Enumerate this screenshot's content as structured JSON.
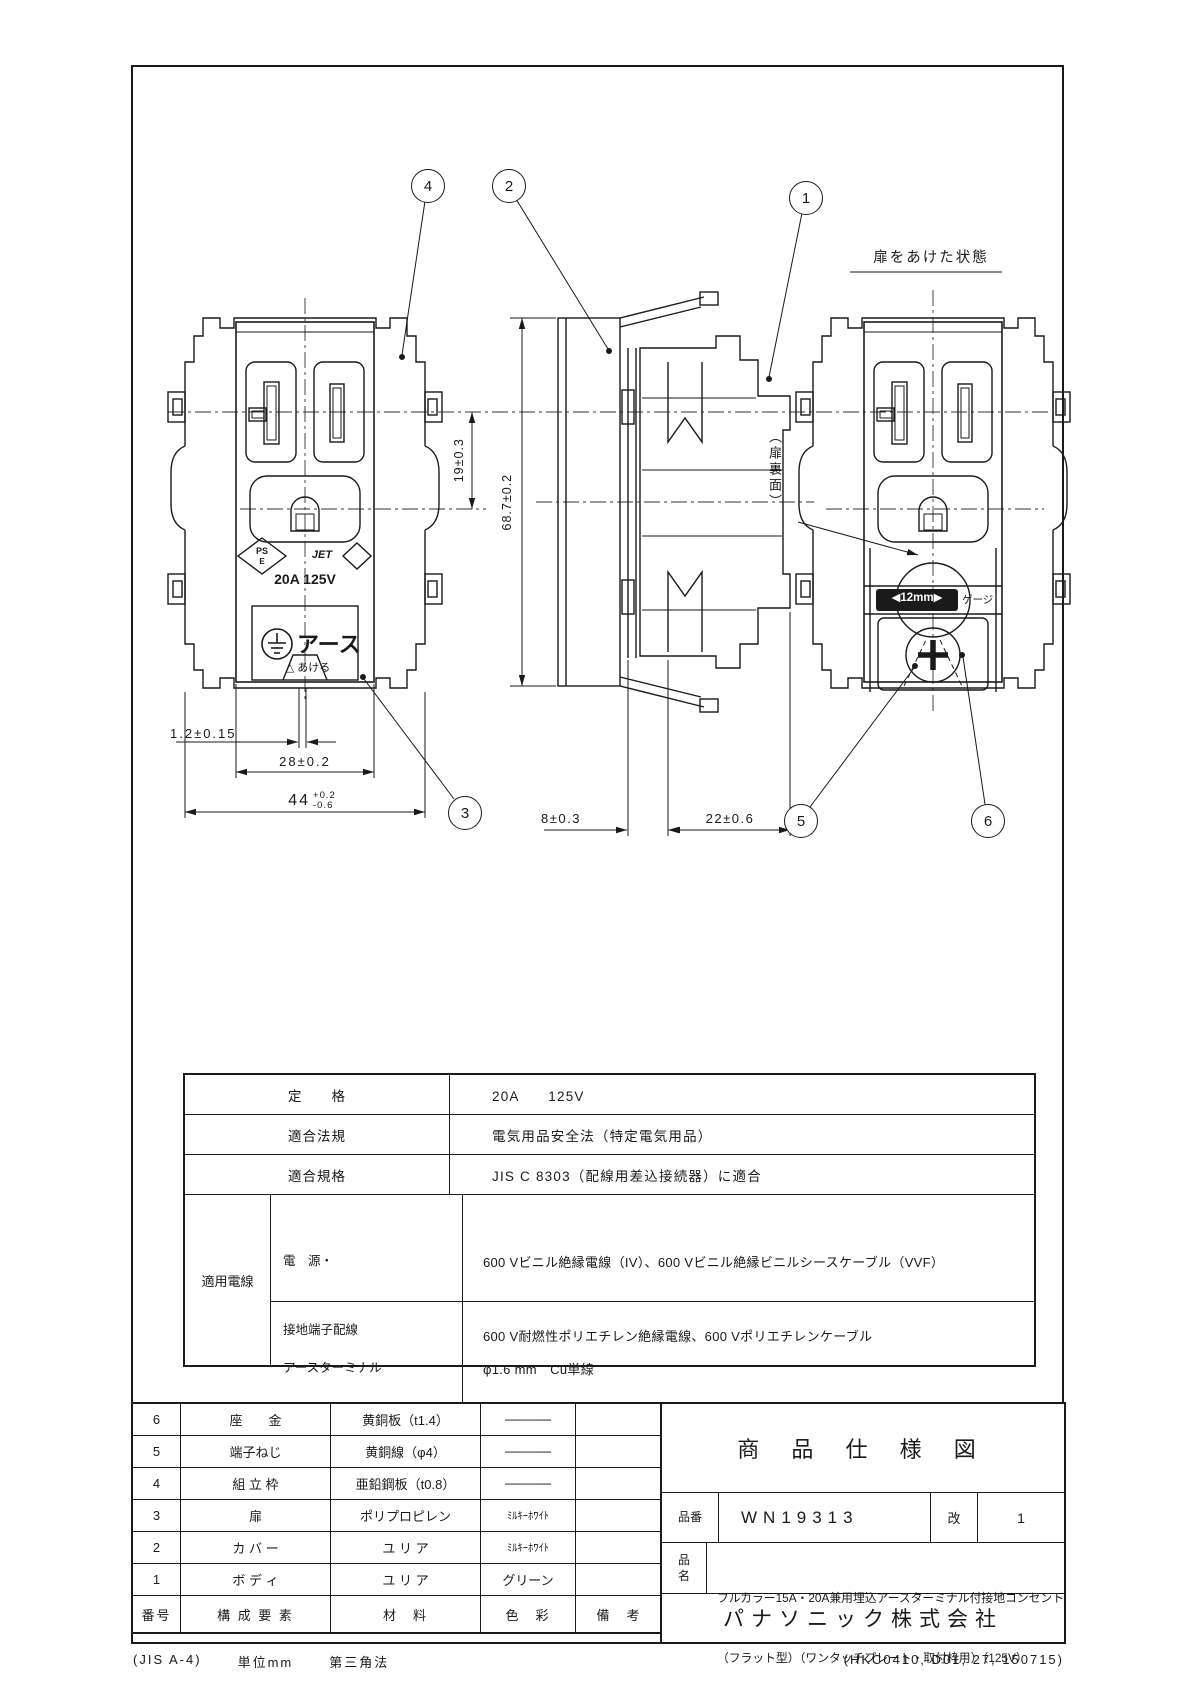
{
  "drawing": {
    "views": {
      "open_door_title": "扉をあけた状態",
      "door_back_label": "（扉裏面）"
    },
    "callouts": [
      "1",
      "2",
      "3",
      "4",
      "5",
      "6"
    ],
    "dims": {
      "slot_to_ground": "19±0.3",
      "height": "68.7±0.2",
      "door_offset": "1.2±0.15",
      "opening_width": "28±0.2",
      "frame_width": "44",
      "frame_width_upper": "+0.2",
      "frame_width_lower": "-0.6",
      "plate_depth": "8±0.3",
      "body_depth": "22±0.6"
    },
    "markings": {
      "ps": "PS",
      "e": "E",
      "jet": "JET",
      "rating": "20A 125V",
      "earth": "アース",
      "open_hint": "△ あける",
      "gauge_strip": "◀12mm▶",
      "gauge": "ゲージ"
    }
  },
  "spec_table": {
    "rating": {
      "label": "定　　格",
      "value": "20A　　125V"
    },
    "law": {
      "label": "適合法規",
      "value": "電気用品安全法（特定電気用品）"
    },
    "standard": {
      "label": "適合規格",
      "value": "JIS C 8303（配線用差込接続器）に適合"
    },
    "wires": {
      "label": "適用電線",
      "power": {
        "label1": "電　源・",
        "label2": "接地端子配線",
        "lines": [
          "600 Vビニル絶縁電線（IV）、600 Vビニル絶縁ビニルシースケーブル（VVF）",
          "600 V耐燃性ポリエチレン絶縁電線、600 Vポリエチレンケーブル",
          "電源線・・・φ2 mm，φ2.6 mm　　Cu単線専用",
          "アース線・・・φ1.6 mm，φ2 mm，φ2.6 mm　　Cu単線専用"
        ]
      },
      "earth_terminal": {
        "label1": "アースターミナル",
        "label2": "配線",
        "lines": [
          "φ1.6 mm　Cu単線",
          "1.25 mm²～2 mm²　（IVより線及びコード）",
          "単線とより線を同時に使用しないでください"
        ]
      }
    }
  },
  "parts_table": {
    "headers": [
      "番号",
      "構 成 要 素",
      "材　料",
      "色　彩",
      "備　考"
    ],
    "rows": [
      {
        "no": "6",
        "component": "座　　金",
        "material": "黄銅板（t1.4）",
        "color": "─────",
        "note": ""
      },
      {
        "no": "5",
        "component": "端子ねじ",
        "material": "黄銅線（φ4）",
        "color": "─────",
        "note": ""
      },
      {
        "no": "4",
        "component": "組 立 枠",
        "material": "亜鉛鋼板（t0.8）",
        "color": "─────",
        "note": ""
      },
      {
        "no": "3",
        "component": "扉",
        "material": "ポリプロピレン",
        "color": "ﾐﾙｷｰﾎﾜｲﾄ",
        "note": ""
      },
      {
        "no": "2",
        "component": "カ バ ー",
        "material": "ユ リ ア",
        "color": "ﾐﾙｷｰﾎﾜｲﾄ",
        "note": ""
      },
      {
        "no": "1",
        "component": "ボ デ ィ",
        "material": "ユ リ ア",
        "color": "グリーン",
        "note": ""
      }
    ]
  },
  "title_block": {
    "doc_title": "商 品 仕 様 図",
    "part_no_label": "品番",
    "part_no": "WN19313",
    "rev_label": "改",
    "rev": "1",
    "name_label": "品名",
    "name_line1": "フルカラー15A・20A兼用埋込アースターミナル付接地コンセント",
    "name_line2": "（フラット型）（ワンタッチプレート・取付枠用）（125V）",
    "company": "パナソニック株式会社"
  },
  "footer": {
    "sheet": "(JIS A-4)",
    "unit": "単位mm",
    "projection": "第三角法",
    "code": "(HKC0410, D01, 27, 150715)"
  }
}
